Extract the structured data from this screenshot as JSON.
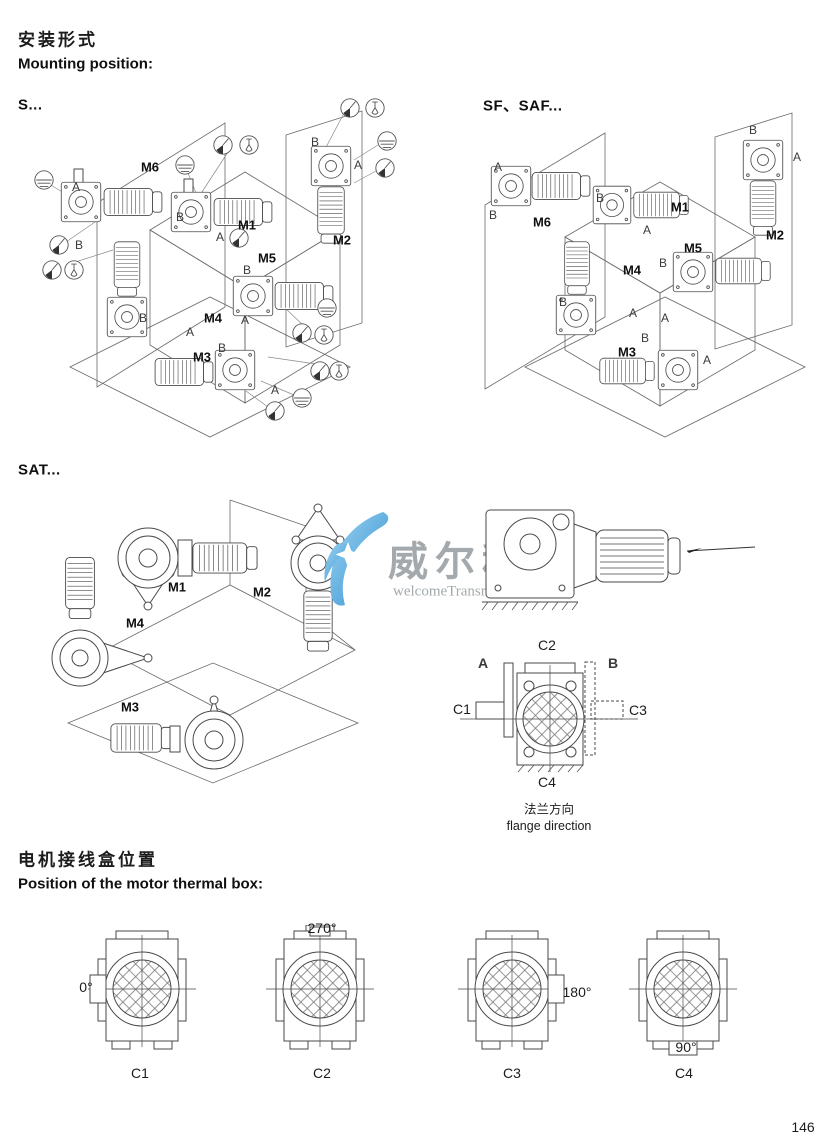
{
  "page_number": "146",
  "mounting_header": {
    "title_zh": "安装形式",
    "title_en": "Mounting position:"
  },
  "sections": {
    "s_label": "S...",
    "sf_label": "SF、SAF...",
    "sat_label": "SAT..."
  },
  "positions": {
    "m1": "M1",
    "m2": "M2",
    "m3": "M3",
    "m4": "M4",
    "m5": "M5",
    "m6": "M6"
  },
  "letters": {
    "a": "A",
    "b": "B"
  },
  "flange": {
    "caption_zh": "法兰方向",
    "caption_en": "flange direction",
    "labels": {
      "c1": "C1",
      "c2": "C2",
      "c3": "C3",
      "c4": "C4"
    }
  },
  "thermal_header": {
    "title_zh": "电机接线盒位置",
    "title_en": "Position of the motor thermal box:"
  },
  "thermal_boxes": [
    {
      "label": "C1",
      "angle": "0°"
    },
    {
      "label": "C2",
      "angle": "270°"
    },
    {
      "label": "C3",
      "angle": "180°"
    },
    {
      "label": "C4",
      "angle": "90°"
    }
  ],
  "watermark": {
    "brand_zh": "威尔科",
    "brand_en": "welcomeTransmission"
  },
  "icons": {
    "oil_level": "oil-level-icon",
    "oil_drain": "oil-drain-icon",
    "vent_valve": "vent-valve-icon"
  },
  "colors": {
    "line": "#4a4a4a",
    "watermark_blue": "#2e8fd0",
    "watermark_gray": "#9aa0a4"
  }
}
